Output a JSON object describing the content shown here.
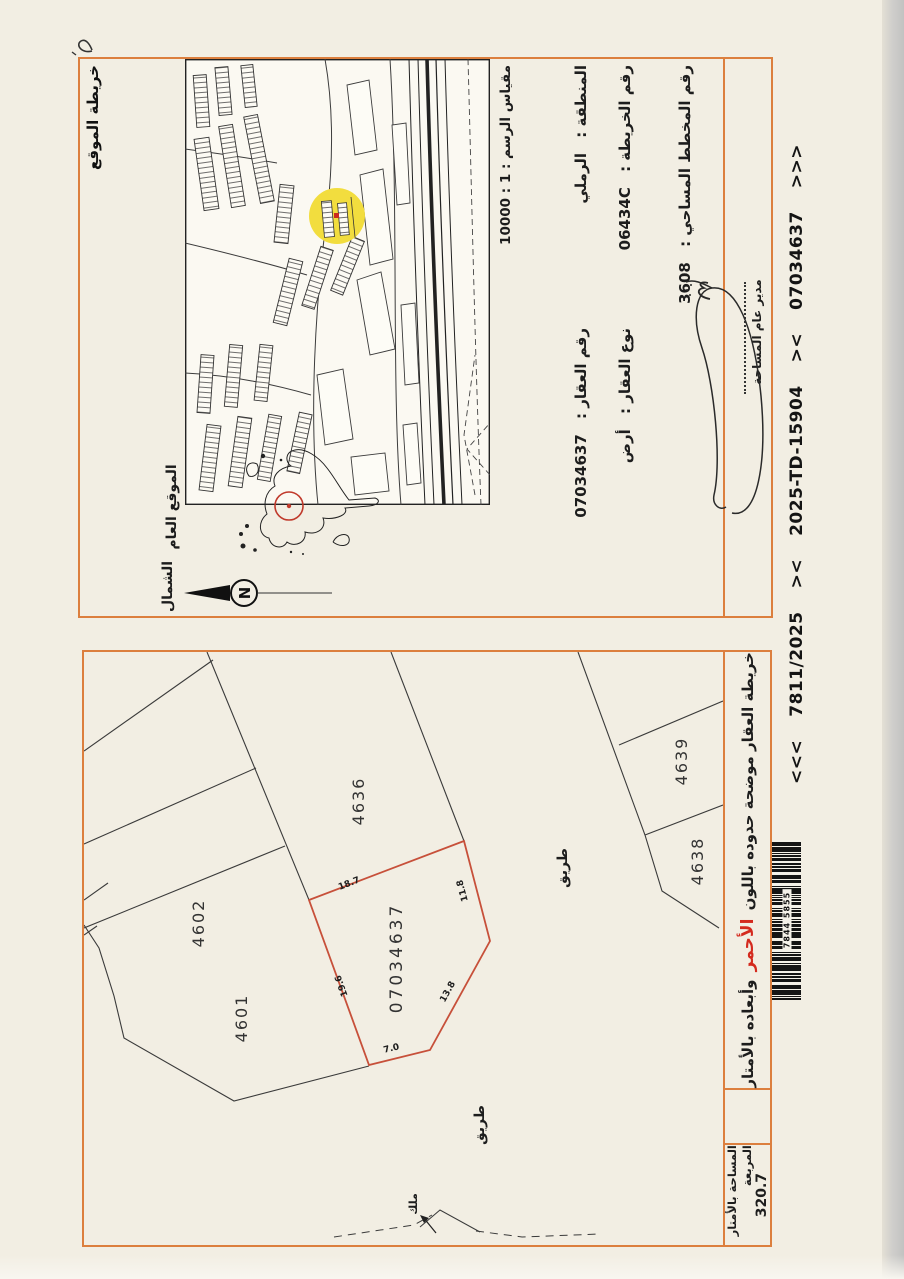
{
  "colors": {
    "border_orange": "#dc7f3e",
    "parcel_red": "#c7503a",
    "note_red": "#d42a1e",
    "highlight_yellow": "#f2dd3e",
    "paper": "#f2eee3"
  },
  "handwriting": {
    "corner_mark": "2"
  },
  "info_panel": {
    "title": "خريطة الموقع",
    "scale_line": "مقياس الرسم : 1 : 10000",
    "region_label": "المنطقة :",
    "region_value": "الرملي",
    "map_no_label": "رقم الخريطة :",
    "map_no_value": "06434C",
    "plan_no_label": "رقم المخطط المساحي :",
    "plan_no_value": "3608",
    "parcel_no_label": "رقم العقار :",
    "parcel_no_value": "07034637",
    "parcel_type_label": "نوع العقار :",
    "parcel_type_value": "أرض",
    "general_location_label": "الموقع العام",
    "north_label": "الشمال",
    "compass_letter": "N",
    "signature_title": "مدير عام المساحة"
  },
  "parcel_map": {
    "parcel_number": "07034637",
    "plots": {
      "p4601": "4601",
      "p4602": "4602",
      "p4636": "4636",
      "p4638": "4638",
      "p4639": "4639"
    },
    "dims": {
      "d18_7": "18.7",
      "d11_8": "11.8",
      "d13_8": "13.8",
      "d7_0": "7.0",
      "d19_6": "19.6"
    },
    "road1": "طريق",
    "road2": "طريق",
    "owner_label": "ملك",
    "area_label": "المساحة بالأمتار المربعة",
    "area_value": "320.7",
    "note_before": "خريطة العقار موضحة حدوده باللون",
    "note_red": "الأحمر",
    "note_after": "وأبعاده بالأمتار"
  },
  "footer": {
    "open": "<<<",
    "ref_case": "7811/2025",
    "sep1": "><",
    "ref_td": "2025-TD-15904",
    "sep2": "><",
    "ref_parcel": "07034637",
    "close": ">>>",
    "barcode_digits": "7844 5855"
  }
}
